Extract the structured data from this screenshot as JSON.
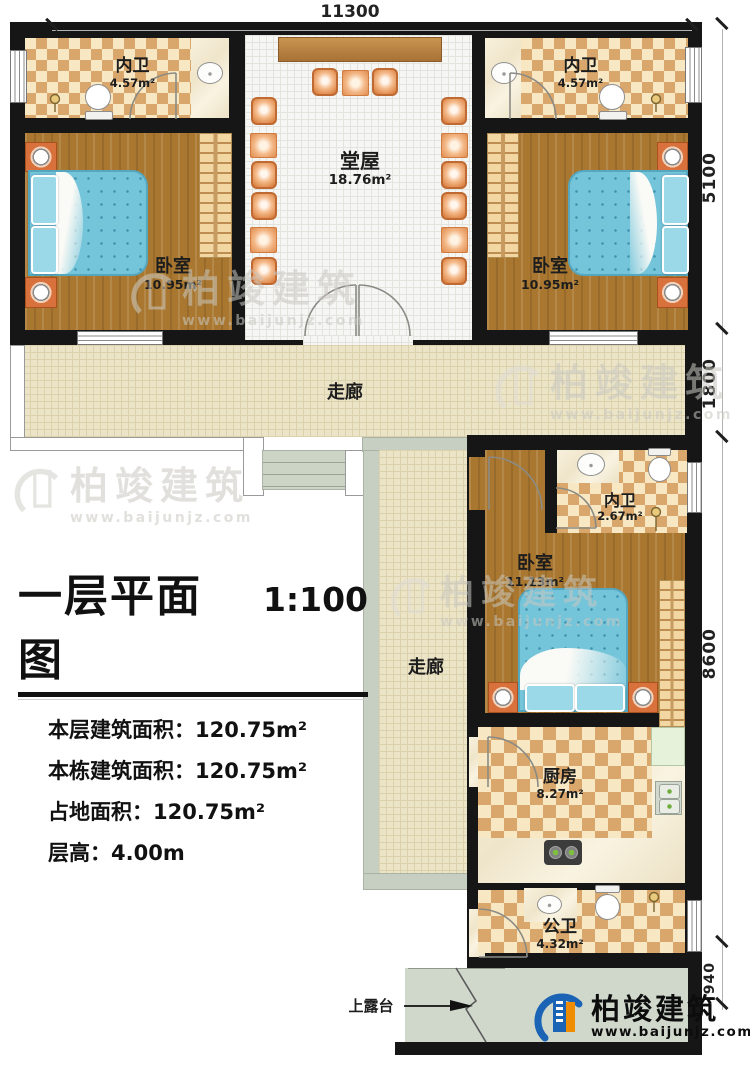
{
  "dimensions": {
    "top": "11300",
    "right_top": "5100",
    "right_mid": "1800",
    "right_main": "8600",
    "right_bottom": "940"
  },
  "rooms": {
    "bath_top_left": {
      "name": "内卫",
      "area": "4.57m²"
    },
    "bath_top_right": {
      "name": "内卫",
      "area": "4.57m²"
    },
    "hall": {
      "name": "堂屋",
      "area": "18.76m²"
    },
    "bedroom_left": {
      "name": "卧室",
      "area": "10.95m²"
    },
    "bedroom_right": {
      "name": "卧室",
      "area": "10.95m²"
    },
    "corridor_horizontal": {
      "name": "走廊"
    },
    "corridor_vertical": {
      "name": "走廊"
    },
    "bath_middle": {
      "name": "内卫",
      "area": "2.67m²"
    },
    "bedroom_middle": {
      "name": "卧室",
      "area": "11.13m²"
    },
    "kitchen": {
      "name": "厨房",
      "area": "8.27m²"
    },
    "bath_bottom": {
      "name": "公卫",
      "area": "4.32m²"
    }
  },
  "title_block": {
    "title": "一层平面图",
    "scale": "1:100",
    "lines": [
      {
        "label": "本层建筑面积：",
        "value": "120.75m²"
      },
      {
        "label": "本栋建筑面积：",
        "value": "120.75m²"
      },
      {
        "label": "占地面积：",
        "value": "120.75m²"
      },
      {
        "label": "层高：",
        "value": "4.00m"
      }
    ]
  },
  "annotations": {
    "terrace": "上露台"
  },
  "brand": {
    "name": "柏竣建筑",
    "url": "www.baijunjz.com"
  },
  "colors": {
    "wall": "#161616",
    "wood": "#a9772f",
    "tile_tan": "#d9a76b",
    "bed_teal": "#74c4da",
    "logo_blue": "#1b63b5",
    "logo_orange": "#f08c00"
  }
}
